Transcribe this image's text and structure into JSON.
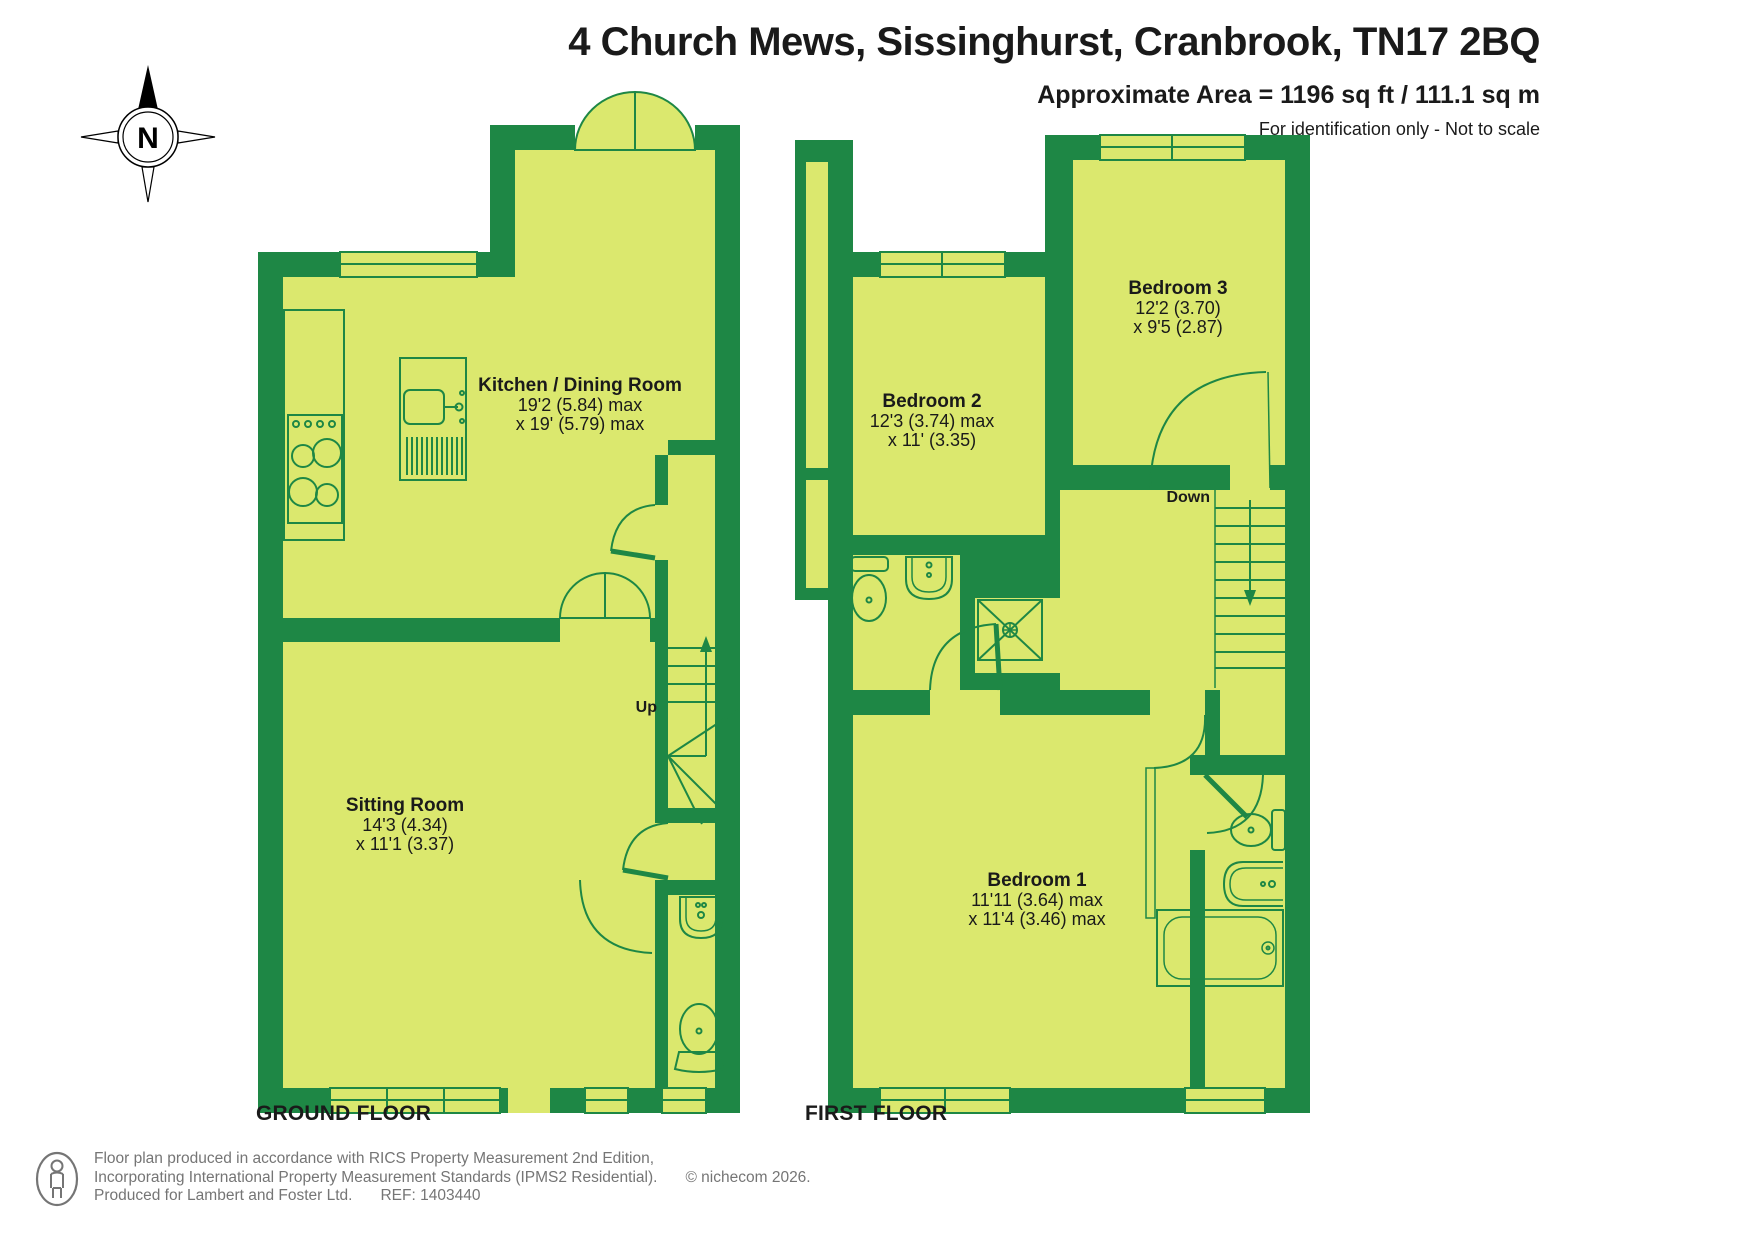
{
  "header": {
    "title": "4 Church Mews, Sissinghurst, Cranbrook, TN17 2BQ",
    "area_line": "Approximate Area = 1196 sq ft / 111.1 sq m",
    "note_line": "For identification only - Not to scale"
  },
  "compass": {
    "north_label": "N"
  },
  "colors": {
    "wall_green": "#1e8745",
    "floor_lime": "#dbe86e",
    "text_black": "#1a1a1a",
    "footer_gray": "#757575"
  },
  "floors": [
    {
      "title": "GROUND FLOOR"
    },
    {
      "title": "FIRST FLOOR"
    }
  ],
  "rooms": {
    "kitchen": {
      "name": "Kitchen / Dining Room",
      "dim1": "19'2 (5.84) max",
      "dim2": "x 19' (5.79) max"
    },
    "sitting": {
      "name": "Sitting Room",
      "dim1": "14'3 (4.34)",
      "dim2": "x 11'1 (3.37)"
    },
    "bedroom2": {
      "name": "Bedroom 2",
      "dim1": "12'3 (3.74) max",
      "dim2": "x 11' (3.35)"
    },
    "bedroom3": {
      "name": "Bedroom 3",
      "dim1": "12'2 (3.70)",
      "dim2": "x 9'5 (2.87)"
    },
    "bedroom1": {
      "name": "Bedroom 1",
      "dim1": "11'11 (3.64) max",
      "dim2": "x 11'4 (3.46) max"
    }
  },
  "stairs": {
    "up_label": "Up",
    "down_label": "Down"
  },
  "footer": {
    "line1": "Floor plan produced in accordance with RICS Property Measurement 2nd Edition,",
    "line2": "Incorporating International Property Measurement Standards (IPMS2 Residential).",
    "copyright": "© nichecom 2026.",
    "line3": "Produced for Lambert and Foster Ltd.",
    "ref": "REF: 1403440"
  }
}
